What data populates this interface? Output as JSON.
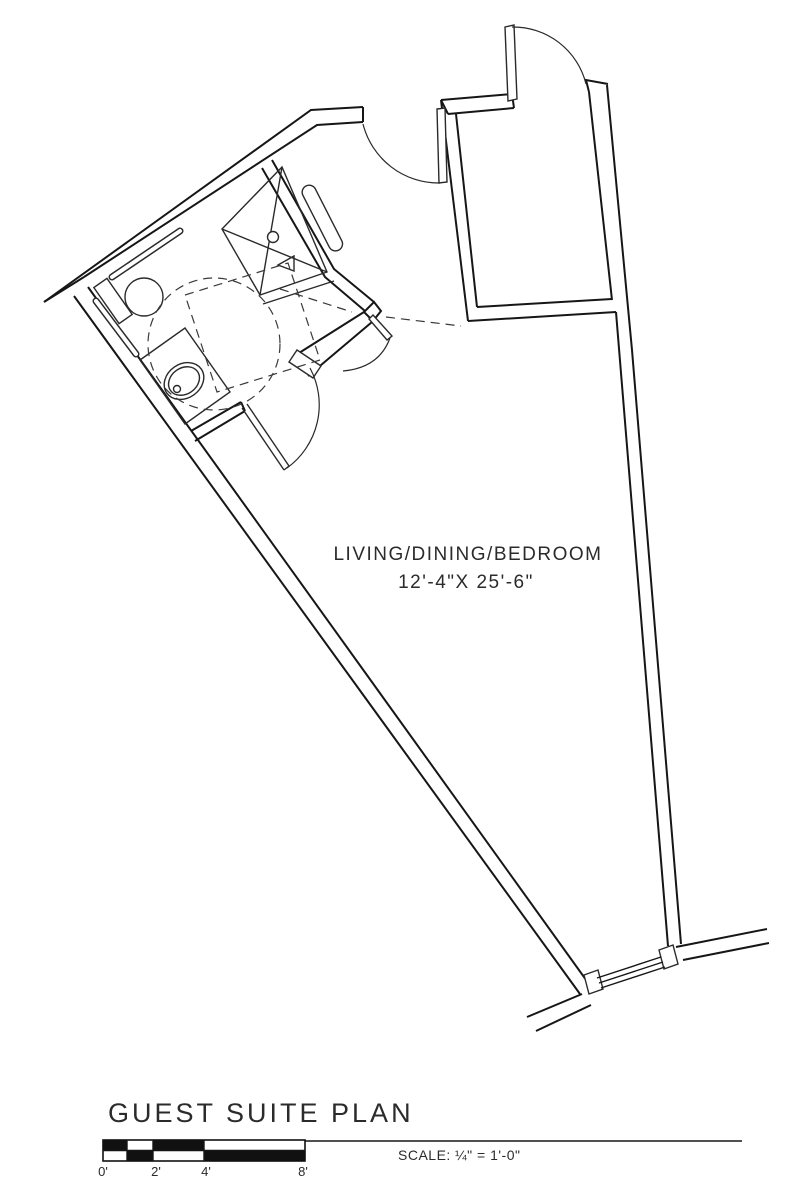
{
  "plan": {
    "room_label_line1": "LIVING/DINING/BEDROOM",
    "room_label_line2": "12'-4\"X 25'-6\"",
    "fixtures": [
      "shower",
      "toilet",
      "sink",
      "grab-bars",
      "wheelchair-clearance"
    ]
  },
  "footer": {
    "title": "GUEST SUITE PLAN",
    "scale_label": "SCALE:",
    "scale_value": "¼\" = 1'-0\"",
    "ruler_labels": [
      "0'",
      "2'",
      "4'",
      "8'"
    ]
  },
  "colors": {
    "line": "#161616",
    "text": "#2b2b2b",
    "background": "#ffffff"
  }
}
